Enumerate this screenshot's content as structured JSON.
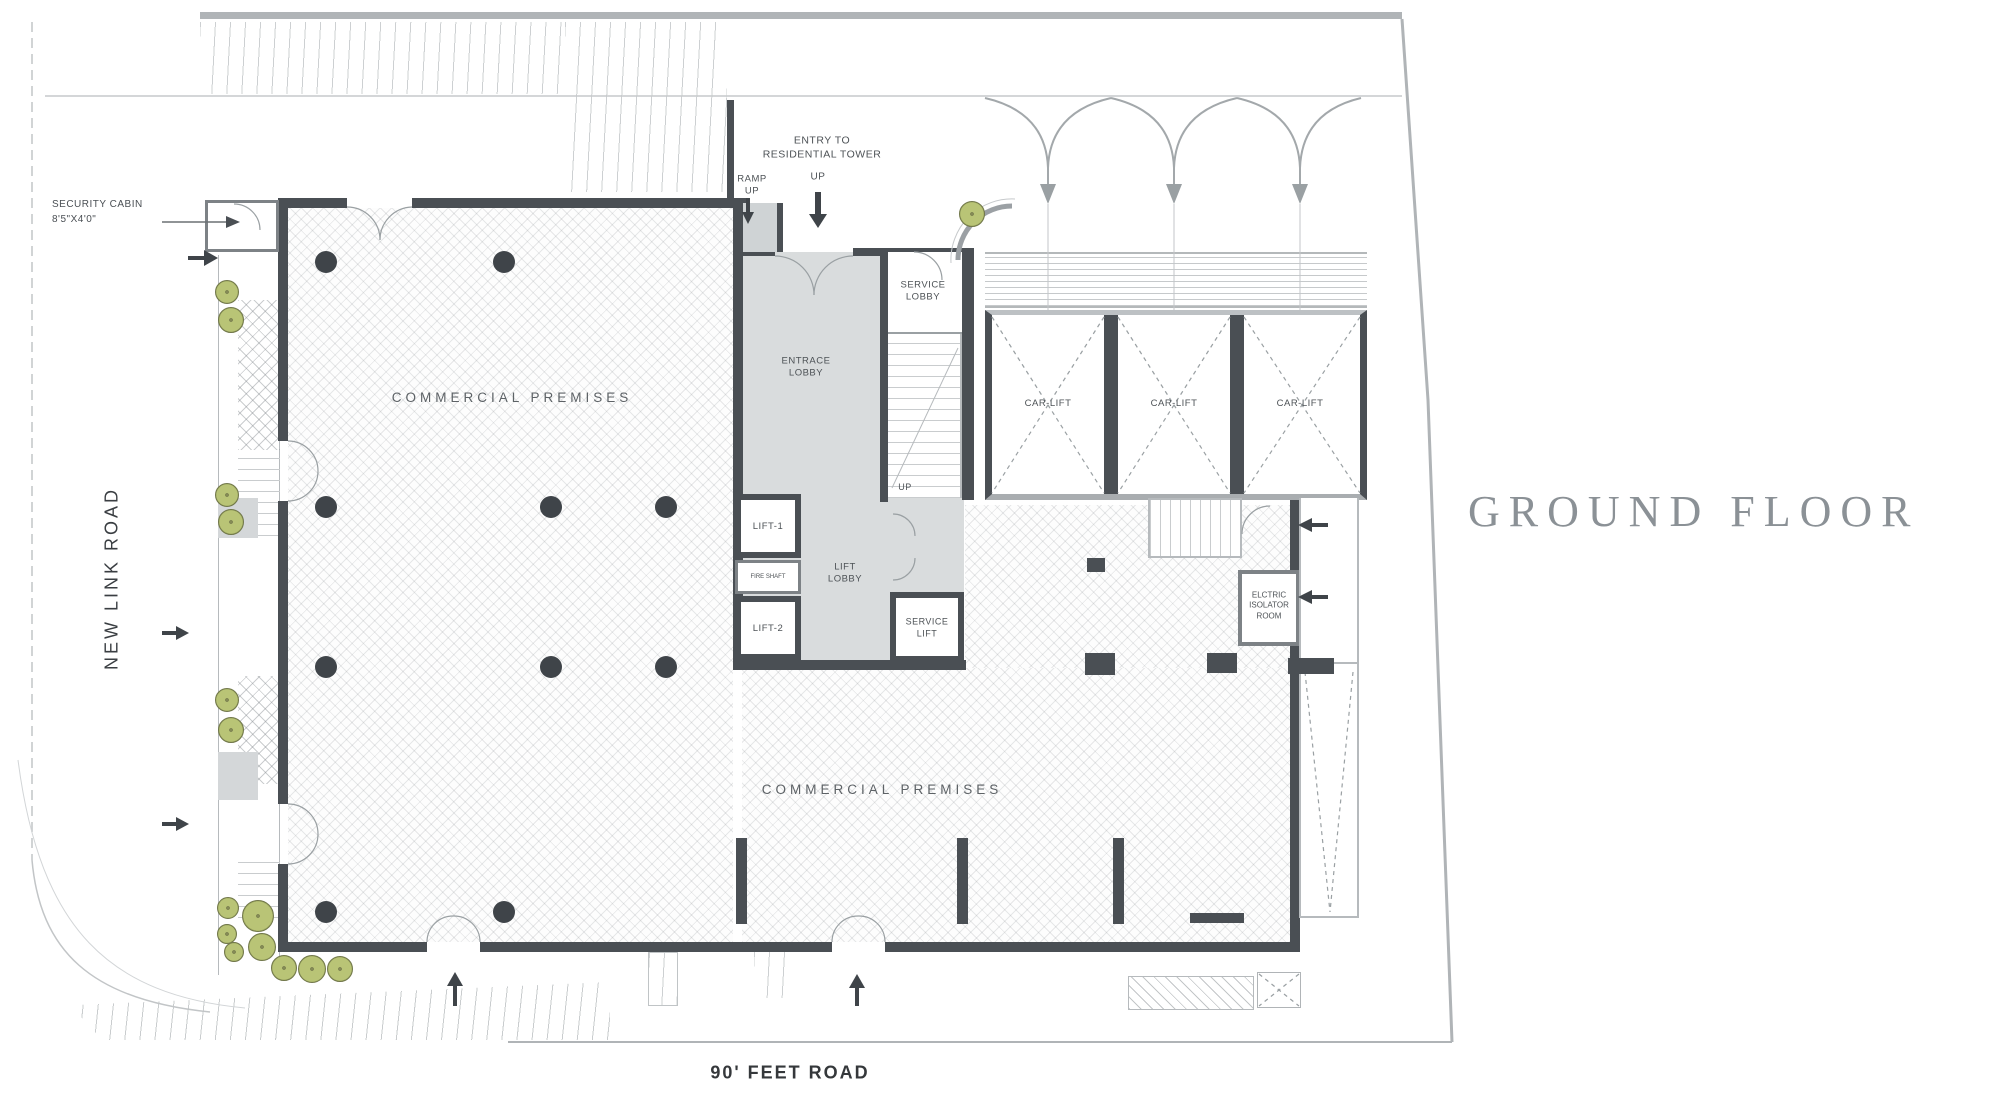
{
  "title": "GROUND FLOOR",
  "roads": {
    "left": "NEW LINK ROAD",
    "bottom": "90' FEET ROAD"
  },
  "annotations": {
    "security_cabin": "SECURITY CABIN\n8'5\"X4'0\"",
    "entry": "ENTRY TO\nRESIDENTIAL TOWER",
    "ramp_up": "RAMP\nUP",
    "up_top": "UP",
    "up_stair": "UP"
  },
  "rooms": {
    "commercial_upper": "COMMERCIAL PREMISES",
    "commercial_lower": "COMMERCIAL PREMISES",
    "entrance_lobby": "ENTRACE\nLOBBY",
    "service_lobby": "SERVICE\nLOBBY",
    "car_lifts": [
      "CAR-LIFT",
      "CAR-LIFT",
      "CAR-LIFT"
    ],
    "lift1": "LIFT-1",
    "lift2": "LIFT-2",
    "fire_shaft": "FIRE SHAFT",
    "lift_lobby": "LIFT\nLOBBY",
    "service_lift": "SERVICE\nLIFT",
    "electric_room": "ELCTRIC\nISOLATOR\nROOM"
  },
  "colors": {
    "wall": "#4a4f54",
    "light_fill": "#d9dcdd",
    "tree_green": "#b9c476",
    "title_gray": "#8b9196"
  },
  "decor": {
    "round_columns": [
      [
        326,
        262
      ],
      [
        504,
        262
      ],
      [
        326,
        507
      ],
      [
        551,
        507
      ],
      [
        666,
        507
      ],
      [
        326,
        667
      ],
      [
        551,
        667
      ],
      [
        666,
        667
      ],
      [
        326,
        912
      ],
      [
        504,
        912
      ]
    ],
    "square_columns": [
      [
        1085,
        653,
        30,
        22
      ],
      [
        1207,
        653,
        30,
        20
      ],
      [
        1087,
        558,
        18,
        14
      ],
      [
        736,
        838,
        11,
        86
      ],
      [
        957,
        838,
        11,
        86
      ],
      [
        1113,
        838,
        11,
        86
      ],
      [
        1190,
        913,
        54,
        10
      ],
      [
        1288,
        658,
        46,
        16
      ]
    ],
    "trees": [
      [
        972,
        214,
        13
      ],
      [
        227,
        292,
        12
      ],
      [
        231,
        320,
        13
      ],
      [
        227,
        495,
        12
      ],
      [
        231,
        522,
        13
      ],
      [
        227,
        700,
        12
      ],
      [
        231,
        730,
        13
      ],
      [
        228,
        908,
        11
      ],
      [
        258,
        916,
        16
      ],
      [
        227,
        934,
        10
      ],
      [
        234,
        952,
        10
      ],
      [
        262,
        947,
        14
      ],
      [
        284,
        968,
        13
      ],
      [
        312,
        969,
        14
      ],
      [
        340,
        969,
        13
      ]
    ]
  }
}
